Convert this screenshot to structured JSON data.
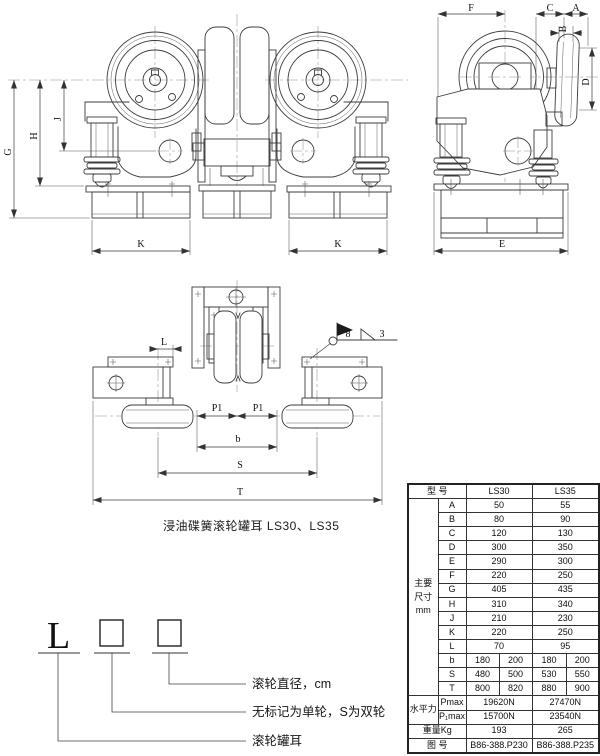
{
  "caption": "浸油碟簧滚轮罐耳 LS30、LS35",
  "top_figure": {
    "dims": {
      "G": "G",
      "H": "H",
      "J": "J",
      "K_left": "K",
      "K_right": "K",
      "F": "F",
      "C": "C",
      "A": "A",
      "B": "B",
      "D": "D",
      "E": "E"
    }
  },
  "layout_figure": {
    "dims": {
      "L": "L",
      "P1_left": "P1",
      "P1_right": "P1",
      "b": "b",
      "S": "S",
      "T": "T"
    },
    "weld_mark": {
      "size": "8",
      "pitch": "3"
    }
  },
  "designation": {
    "prefix": "L",
    "callouts": [
      {
        "label": "滚轮直径，cm"
      },
      {
        "label": "无标记为单轮，S为双轮"
      },
      {
        "label": "滚轮罐耳"
      }
    ]
  },
  "table": {
    "header": {
      "model_label": "型 号",
      "models": [
        "LS30",
        "LS35"
      ]
    },
    "dims_group_label": [
      "主要",
      "尺寸",
      "mm"
    ],
    "dim_rows": [
      {
        "name": "A",
        "ls30": [
          "50"
        ],
        "ls35": [
          "55"
        ]
      },
      {
        "name": "B",
        "ls30": [
          "80"
        ],
        "ls35": [
          "90"
        ]
      },
      {
        "name": "C",
        "ls30": [
          "120"
        ],
        "ls35": [
          "130"
        ]
      },
      {
        "name": "D",
        "ls30": [
          "300"
        ],
        "ls35": [
          "350"
        ]
      },
      {
        "name": "E",
        "ls30": [
          "290"
        ],
        "ls35": [
          "300"
        ]
      },
      {
        "name": "F",
        "ls30": [
          "220"
        ],
        "ls35": [
          "250"
        ]
      },
      {
        "name": "G",
        "ls30": [
          "405"
        ],
        "ls35": [
          "435"
        ]
      },
      {
        "name": "H",
        "ls30": [
          "310"
        ],
        "ls35": [
          "340"
        ]
      },
      {
        "name": "J",
        "ls30": [
          "210"
        ],
        "ls35": [
          "230"
        ]
      },
      {
        "name": "K",
        "ls30": [
          "220"
        ],
        "ls35": [
          "250"
        ]
      },
      {
        "name": "L",
        "ls30": [
          "70"
        ],
        "ls35": [
          "95"
        ]
      },
      {
        "name": "b",
        "ls30": [
          "180",
          "200"
        ],
        "ls35": [
          "180",
          "200"
        ]
      },
      {
        "name": "S",
        "ls30": [
          "480",
          "500"
        ],
        "ls35": [
          "530",
          "550"
        ]
      },
      {
        "name": "T",
        "ls30": [
          "800",
          "820"
        ],
        "ls35": [
          "880",
          "900"
        ]
      }
    ],
    "horizontal_force_label": "水平力",
    "force_rows": [
      {
        "name": "Pmax",
        "ls30": "19620N",
        "ls35": "27470N"
      },
      {
        "name": "P₁max",
        "ls30": "15700N",
        "ls35": "23540N"
      }
    ],
    "weight_row": {
      "label": "重量Kg",
      "ls30": "193",
      "ls35": "265"
    },
    "drawing_no_row": {
      "label": "图 号",
      "ls30": "B86-388.P230",
      "ls35": "B86-388.P235"
    }
  }
}
